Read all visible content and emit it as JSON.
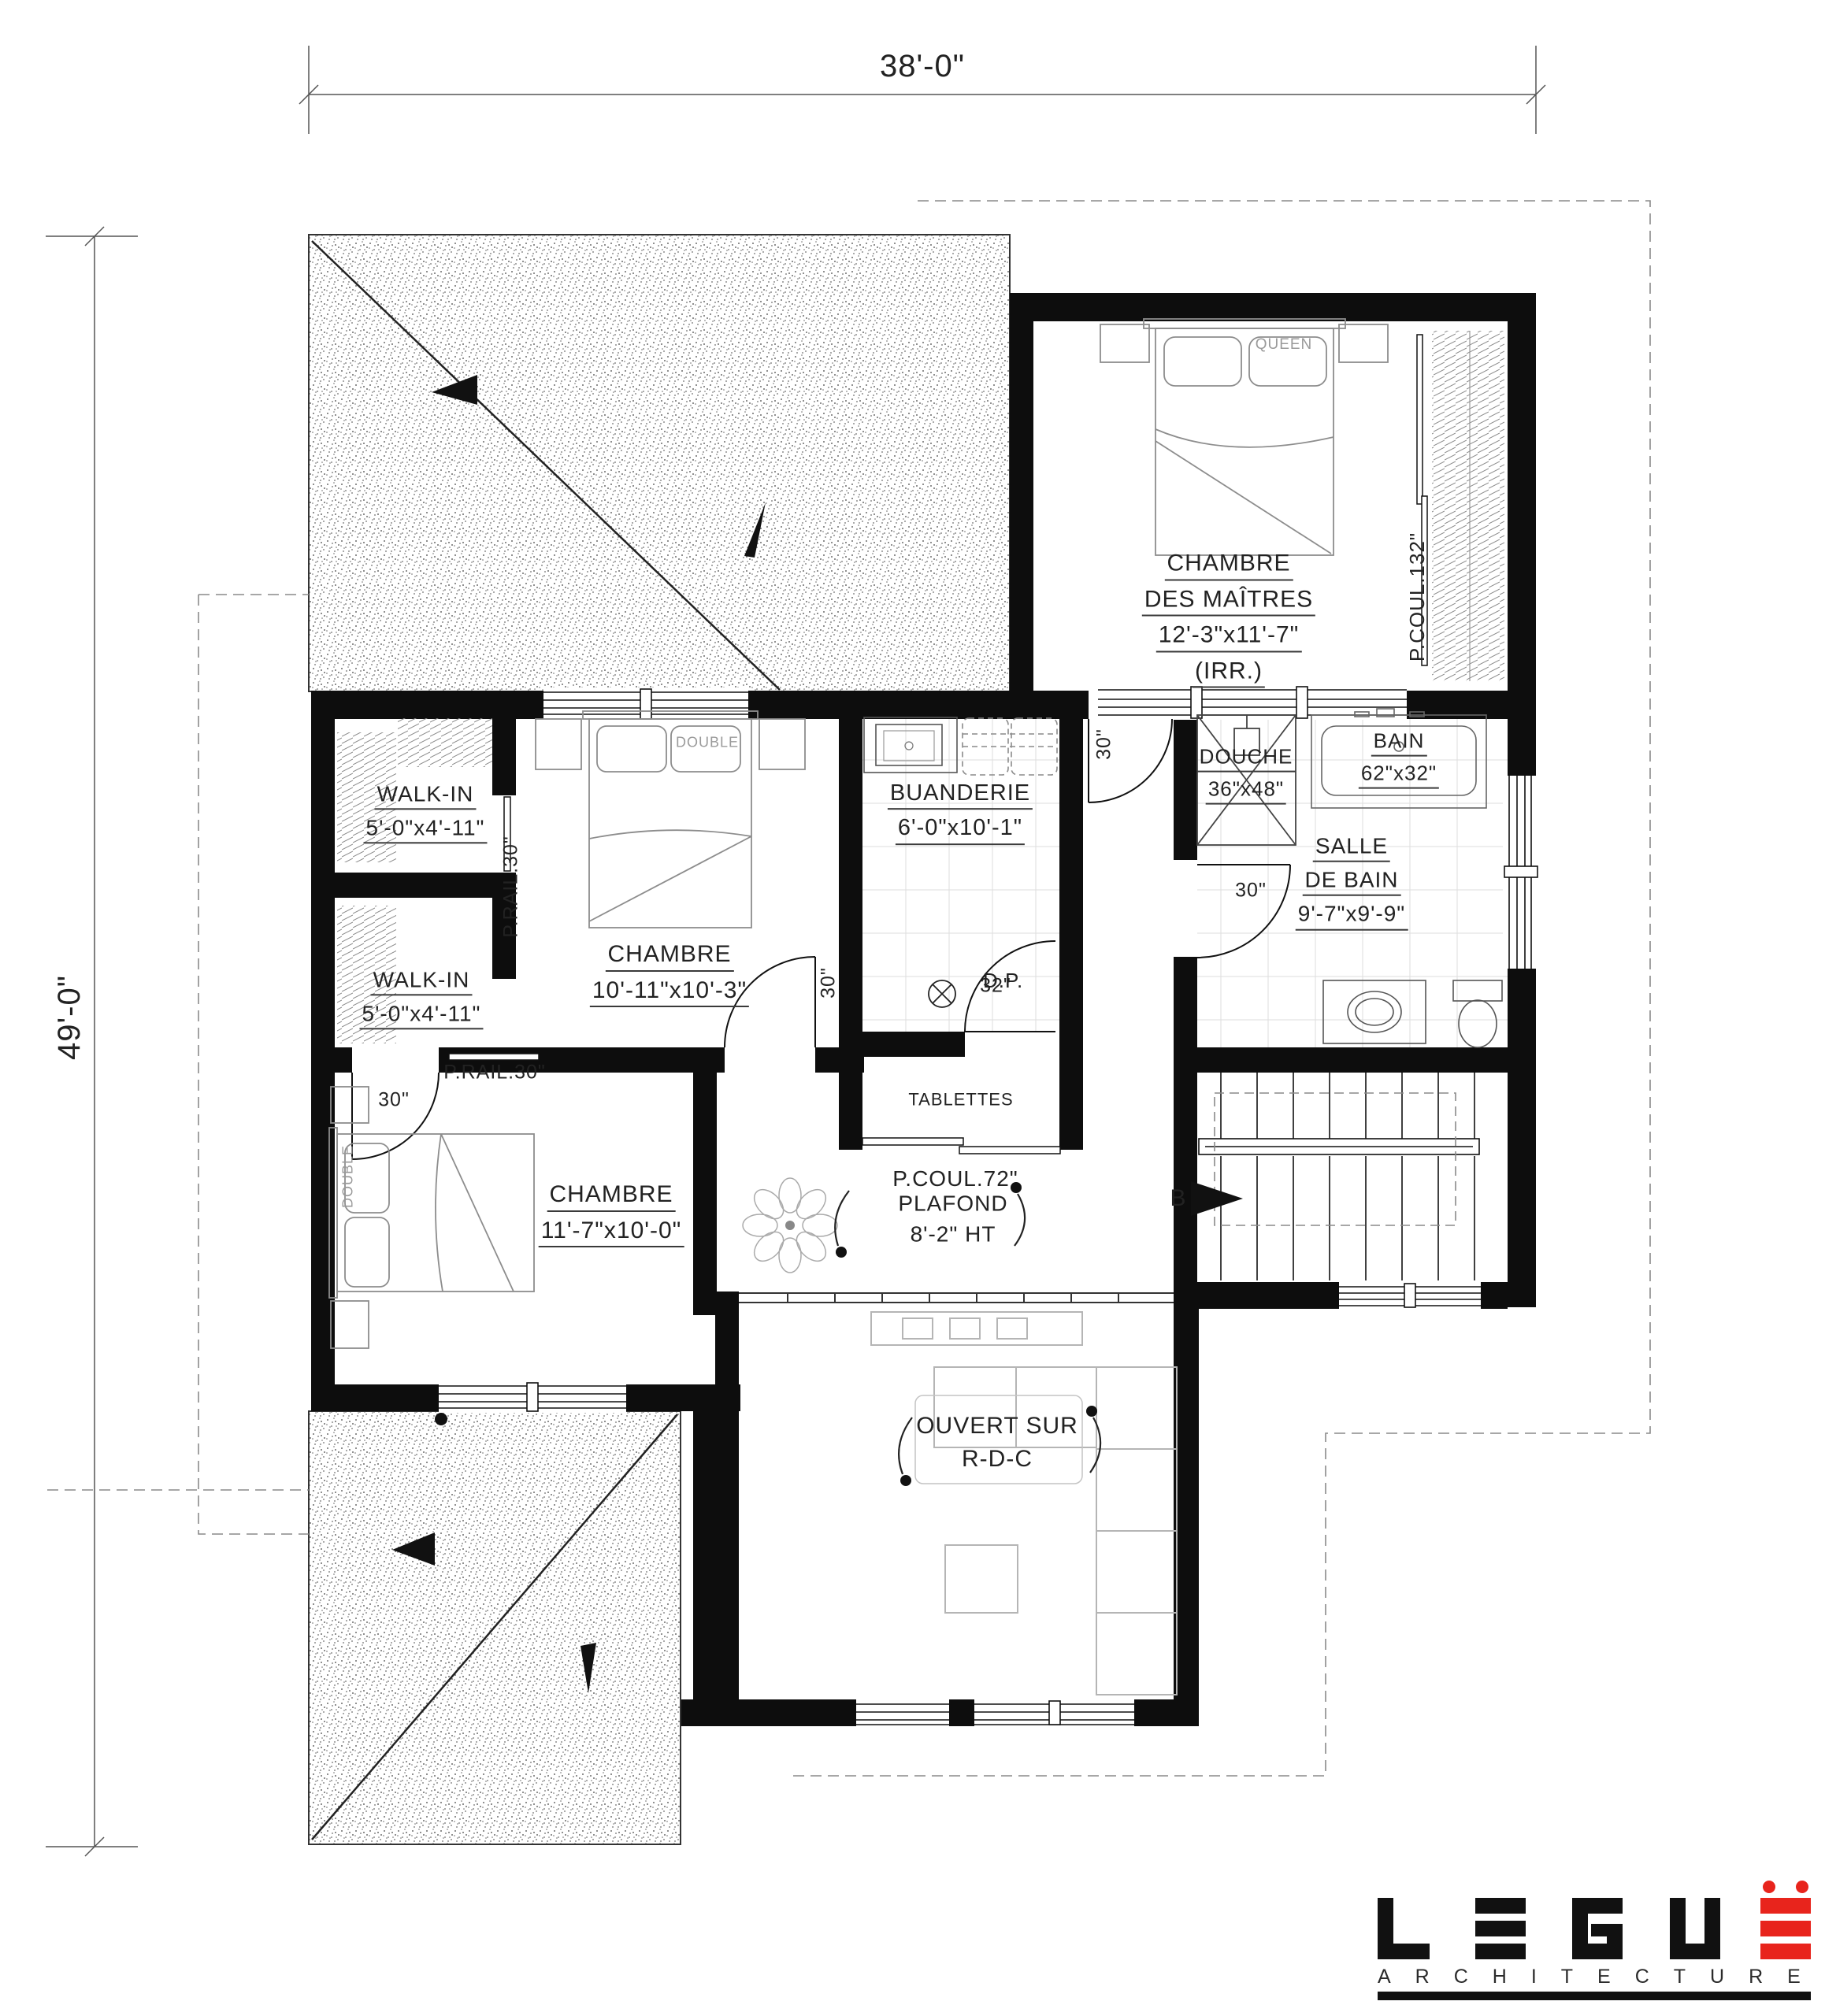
{
  "dimensions": {
    "width": "38'-0\"",
    "height": "49'-0\""
  },
  "rooms": {
    "master_bedroom": {
      "name": "CHAMBRE",
      "name2": "DES MAÎTRES",
      "size": "12'-3\"x11'-7\"",
      "note": "(IRR.)",
      "bed_label": "QUEEN",
      "closet_label": "P.COUL.132\"",
      "door_width": "30\""
    },
    "walk_in_1": {
      "name": "WALK-IN",
      "size": "5'-0\"x4'-11\"",
      "rail_label": "P.RAIL.30\""
    },
    "walk_in_2": {
      "name": "WALK-IN",
      "size": "5'-0\"x4'-11\"",
      "rail_label": "P.RAIL.30\""
    },
    "bedroom_2": {
      "name": "CHAMBRE",
      "size": "10'-11\"x10'-3\"",
      "bed_label": "DOUBLE",
      "door_width": "30\""
    },
    "bedroom_3": {
      "name": "CHAMBRE",
      "size": "11'-7\"x10'-0\"",
      "bed_label": "DOUBLE",
      "door_width": "30\""
    },
    "laundry": {
      "name": "BUANDERIE",
      "size": "6'-0\"x10'-1\"",
      "door_width": "32\"",
      "drain_label": "D.P."
    },
    "shower": {
      "name": "DOUCHE",
      "size": "36\"x48\""
    },
    "bath": {
      "name": "BAIN",
      "size": "62\"x32\""
    },
    "bathroom": {
      "name": "SALLE",
      "name2": "DE BAIN",
      "size": "9'-7\"x9'-9\"",
      "door_width": "30\""
    },
    "hall_closet": {
      "shelves_label": "TABLETTES",
      "door_label": "P.COUL.72\""
    },
    "hall": {
      "ceiling_note_1": "PLAFOND",
      "ceiling_note_2": "8'-2\" HT"
    },
    "open_to_below": {
      "line1": "OUVERT SUR",
      "line2": "R-D-C"
    },
    "stairs": {
      "section_marker": "B"
    }
  },
  "logo": {
    "name": "LEGU",
    "subtitle": "ARCHITECTURE",
    "accent_color": "#e8241c"
  }
}
